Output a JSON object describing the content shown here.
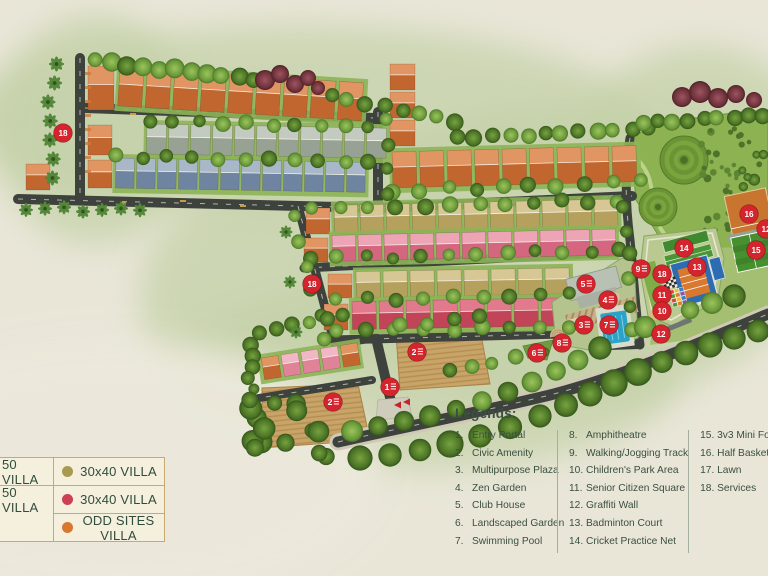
{
  "villa_legend": {
    "left_column": [
      {
        "label": "50 VILLA"
      },
      {
        "label": "50 VILLA"
      }
    ],
    "right_column": [
      {
        "dot_color": "#a89b51",
        "label": "30x40 VILLA"
      },
      {
        "dot_color": "#ce3e54",
        "label": "30x40 VILLA"
      },
      {
        "dot_color": "#d9772e",
        "label": "ODD SITES VILLA"
      }
    ]
  },
  "legends_panel": {
    "heading": "Legends:",
    "columns": [
      [
        {
          "num": "1.",
          "label": "Entry Portal"
        },
        {
          "num": "2.",
          "label": "Civic Amenity"
        },
        {
          "num": "3.",
          "label": "Multipurpose Plaza"
        },
        {
          "num": "4.",
          "label": "Zen Garden"
        },
        {
          "num": "5.",
          "label": "Club House"
        },
        {
          "num": "6.",
          "label": "Landscaped Garden"
        },
        {
          "num": "7.",
          "label": "Swimming Pool"
        }
      ],
      [
        {
          "num": "8.",
          "label": "Amphitheatre"
        },
        {
          "num": "9.",
          "label": "Walking/Jogging Track"
        },
        {
          "num": "10.",
          "label": "Children's Park Area"
        },
        {
          "num": "11.",
          "label": "Senior Citizen Square"
        },
        {
          "num": "12.",
          "label": "Graffiti Wall"
        },
        {
          "num": "13.",
          "label": "Badminton Court"
        },
        {
          "num": "14.",
          "label": "Cricket Practice Net"
        }
      ],
      [
        {
          "num": "15.",
          "label": "3v3 Mini Football"
        },
        {
          "num": "16.",
          "label": "Half Basketball"
        },
        {
          "num": "17.",
          "label": "Lawn"
        },
        {
          "num": "18.",
          "label": "Services"
        }
      ]
    ]
  },
  "map_markers": [
    {
      "num": "18",
      "x": 63,
      "y": 133
    },
    {
      "num": "18",
      "x": 312,
      "y": 284
    },
    {
      "num": "2",
      "x": 417,
      "y": 352
    },
    {
      "num": "1",
      "x": 390,
      "y": 387
    },
    {
      "num": "2",
      "x": 333,
      "y": 402
    },
    {
      "num": "6",
      "x": 537,
      "y": 353
    },
    {
      "num": "8",
      "x": 562,
      "y": 343
    },
    {
      "num": "3",
      "x": 584,
      "y": 325
    },
    {
      "num": "7",
      "x": 609,
      "y": 325
    },
    {
      "num": "4",
      "x": 608,
      "y": 300
    },
    {
      "num": "5",
      "x": 586,
      "y": 284
    },
    {
      "num": "9",
      "x": 641,
      "y": 269
    },
    {
      "num": "18",
      "x": 662,
      "y": 274
    },
    {
      "num": "11",
      "x": 662,
      "y": 295
    },
    {
      "num": "10",
      "x": 662,
      "y": 311
    },
    {
      "num": "12",
      "x": 661,
      "y": 334
    },
    {
      "num": "14",
      "x": 684,
      "y": 248
    },
    {
      "num": "13",
      "x": 697,
      "y": 267
    },
    {
      "num": "16",
      "x": 749,
      "y": 214
    },
    {
      "num": "15",
      "x": 756,
      "y": 250
    },
    {
      "num": "12",
      "x": 766,
      "y": 229
    }
  ],
  "colors": {
    "background": "#e9e6d8",
    "green_wash": "#c6d2ac",
    "road": "#3e423c",
    "marker_red": "#d4242e",
    "park_green": "#8cb251",
    "pool_blue": "#2ba2c8",
    "court_blue": "#2e6cb2",
    "court_orange": "#d9782f",
    "field_green": "#47902f",
    "plot_brown": "#c9a468",
    "legend_text": "#3a4f41",
    "villa_orange": "#c2662f",
    "villa_gray": "#97a295",
    "villa_blue": "#6e84a0",
    "villa_khaki": "#b5a05e",
    "villa_pink": "#d4667f",
    "villa_red": "#c24458"
  }
}
